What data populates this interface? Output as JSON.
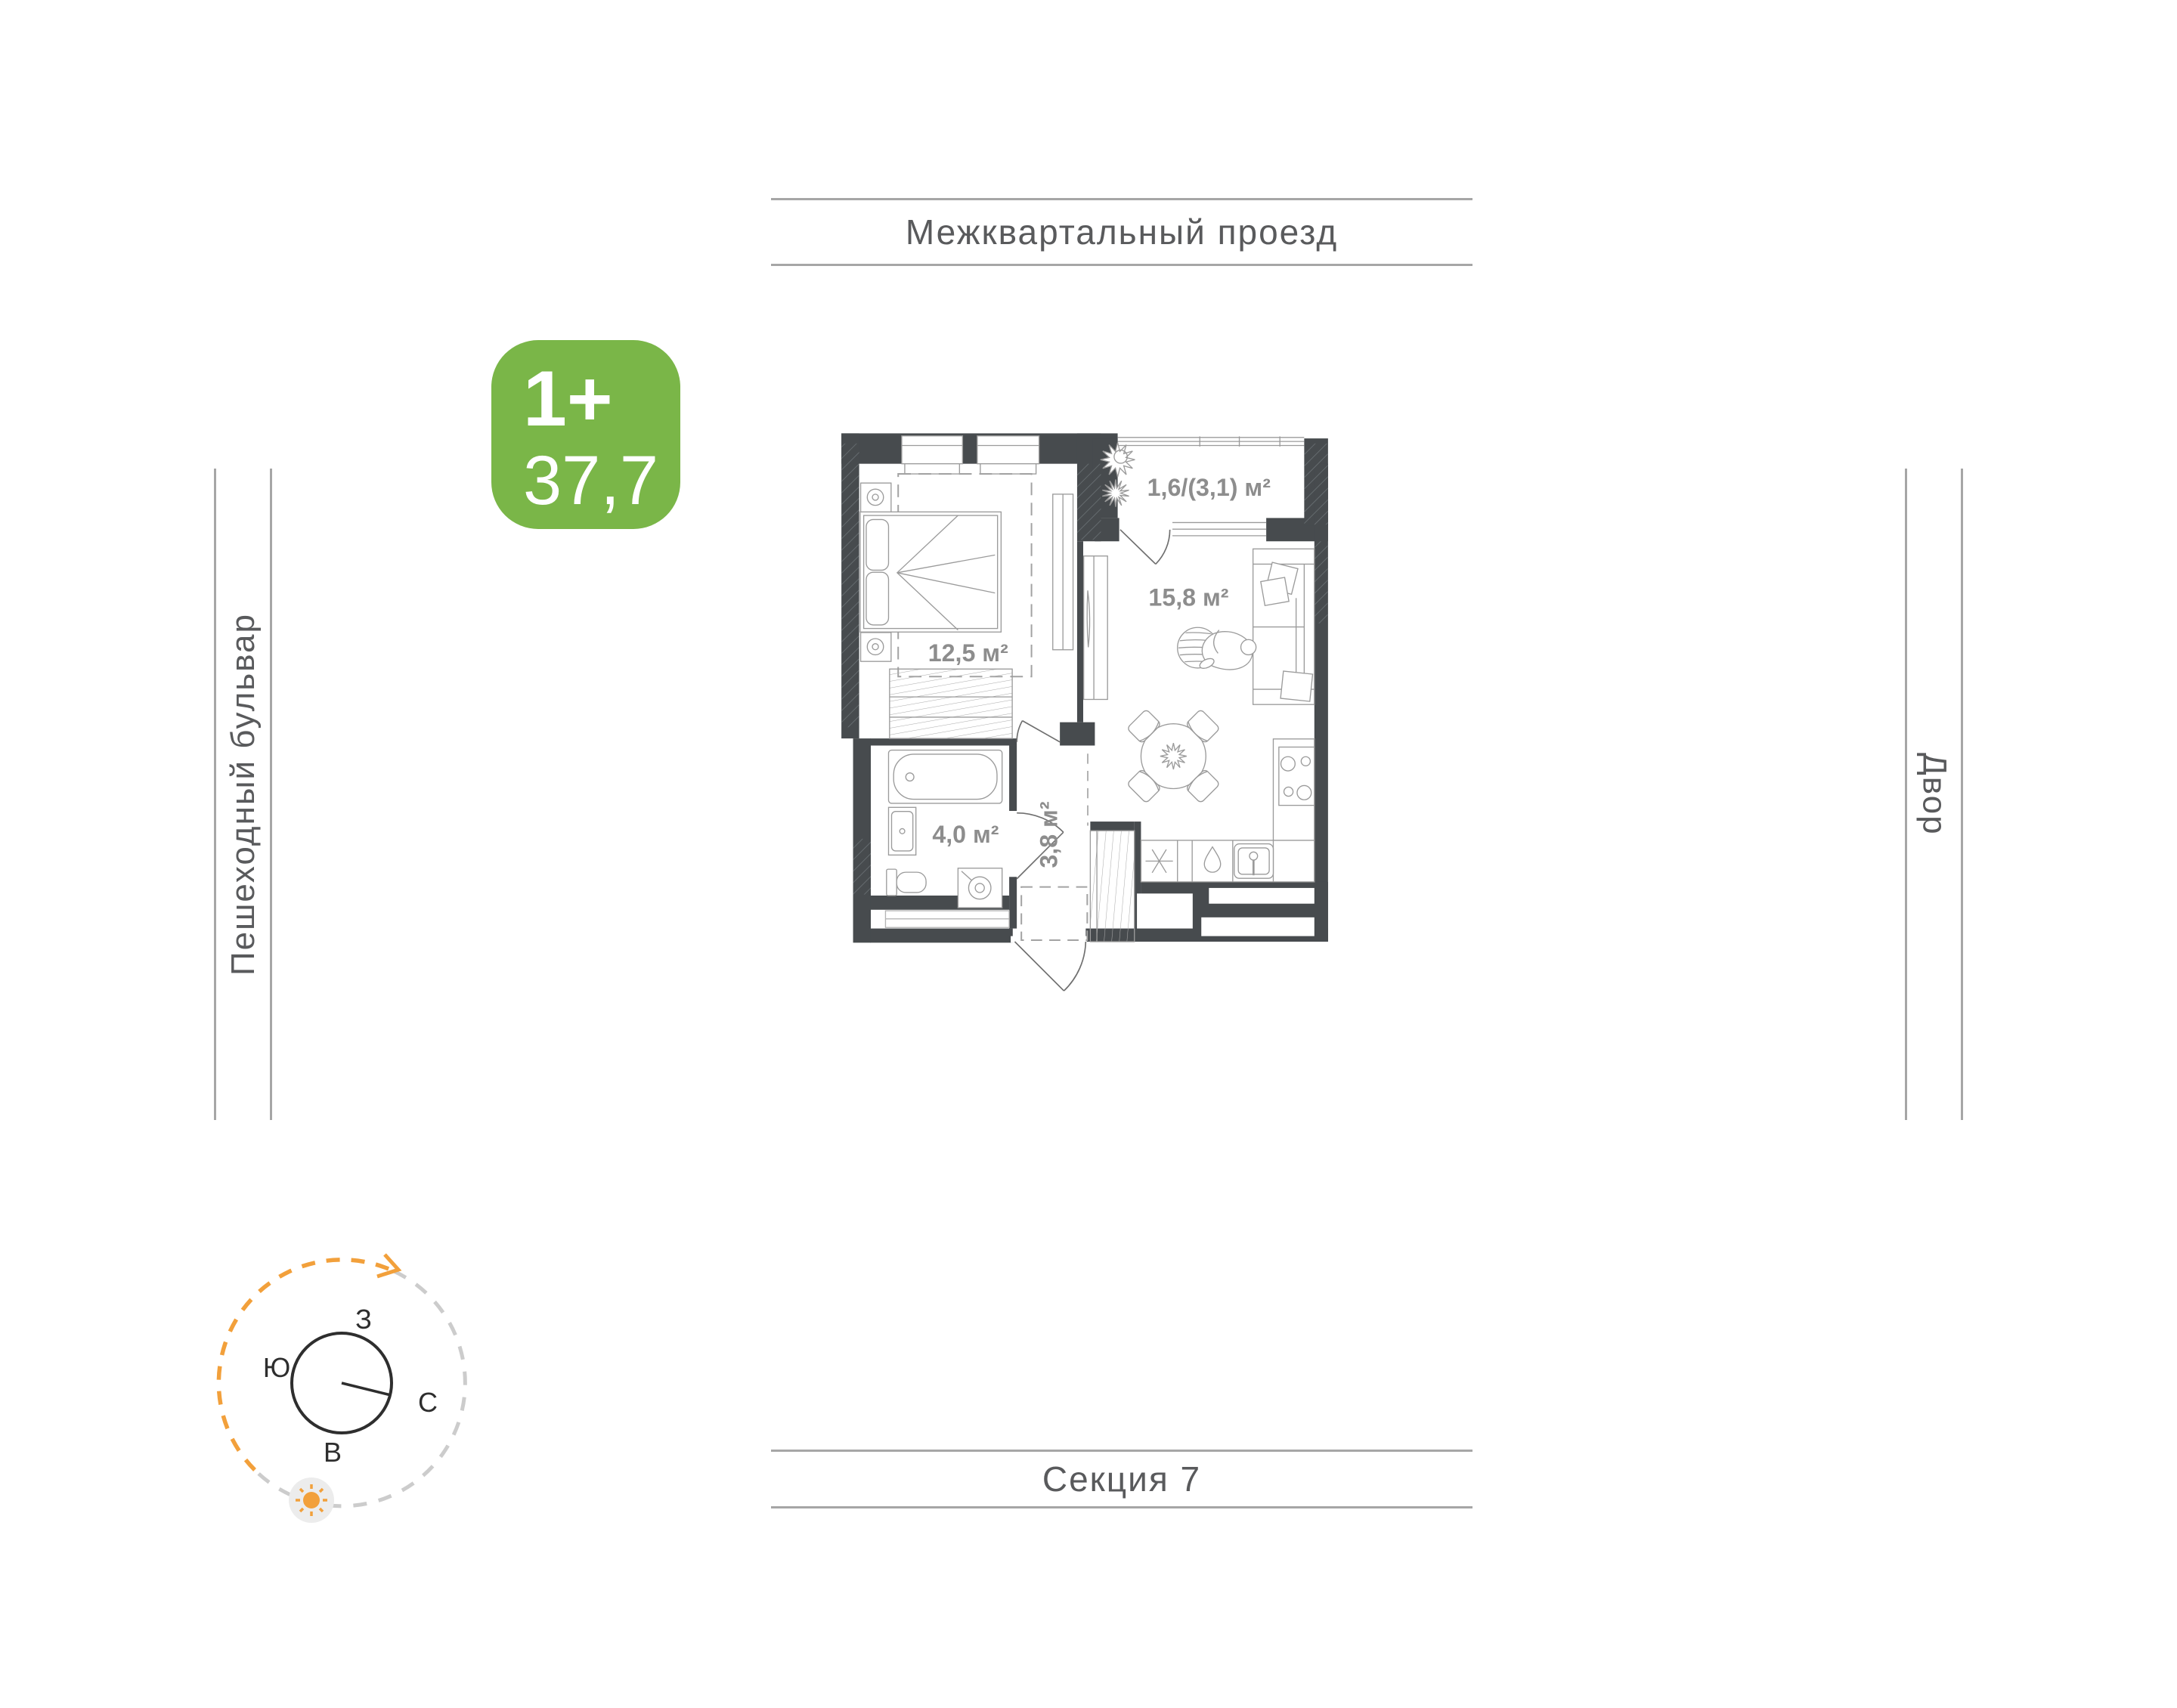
{
  "surroundings": {
    "top_label": "Межквартальный проезд",
    "left_label": "Пешеходный бульвар",
    "right_label": "Двор",
    "bottom_label": "Секция 7"
  },
  "badge": {
    "type_label": "1+",
    "area_value": "37,7"
  },
  "rooms": {
    "bedroom": {
      "area": "12,5 м²"
    },
    "living_kitchen": {
      "area": "15,8 м²"
    },
    "bathroom": {
      "area": "4,0 м²"
    },
    "hallway": {
      "area": "3,8 м²"
    },
    "balcony": {
      "area": "1,6/(3,1) м²"
    }
  },
  "compass": {
    "west": "З",
    "south": "Ю",
    "north": "С",
    "east": "В"
  },
  "colors": {
    "badge_green": "#7ab648",
    "wall_dark": "#474b4e",
    "area_text": "#8d8d8d",
    "street_text": "#595a5c",
    "street_line": "#a6a6a6",
    "furniture_line": "#9b9b9b",
    "compass_orange": "#f2a03b"
  }
}
